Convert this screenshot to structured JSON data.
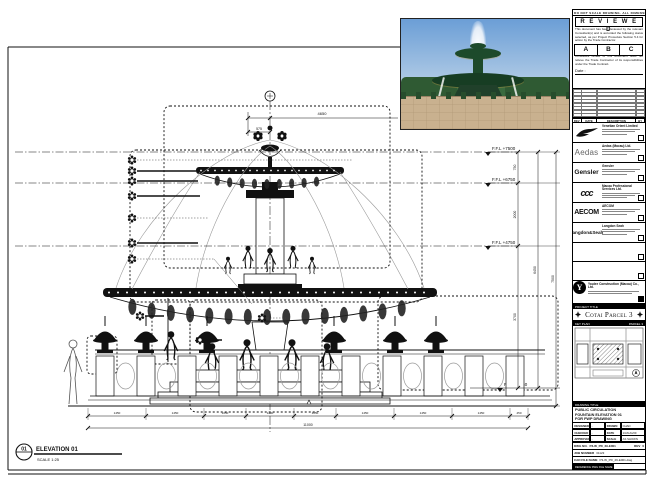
{
  "sheet_notes": {
    "top_strip": "DO NOT SCALE DRAWING. ALL DIMENSIONS TO BE VERIFIED ON SITE."
  },
  "stamp": {
    "title": "R E V I E W E D",
    "body1": "This document has been reviewed by the relevant Consultant(s) and is accorded the following status selected, as per Project Procedure Section 5.4 for action by the Trade Contractor.",
    "options": [
      "A",
      "B",
      "C"
    ],
    "body2": "Consultant review of this document does not relieve the Trade Contractor of its responsibilities under the Trade Contract.",
    "date_label": "Date :"
  },
  "revision_table": {
    "col_rev": "REV",
    "col_date": "DATE",
    "col_desc": "DESCRIPTION",
    "col_by": "BY"
  },
  "consultants": [
    {
      "name": "Venetian Orient Limited"
    },
    {
      "name": "Aedas (Macau) Ltd.",
      "logo_text": "Aedas"
    },
    {
      "name": "Gensler",
      "logo_text": "Gensler"
    },
    {
      "name": "Macau Professional Services Ltd.",
      "logo_text": "ccc"
    },
    {
      "name": "AECOM",
      "logo_text": "AECOM"
    },
    {
      "name": "Langdon Seah",
      "logo_text": "Langdon&Seah"
    }
  ],
  "contractor": {
    "name": "Youlee Construction (Macau) Co., Ltd.",
    "logo_letter": "Y"
  },
  "project": {
    "section_label": "PROJECT TITLE",
    "name": "Cotai Parcel 3"
  },
  "key_plan": {
    "section_label": "KEY PLAN",
    "parcel_label": "PARCEL 3"
  },
  "drawing_title": {
    "section_label": "DRAWING TITLE",
    "line1": "PUBLIC CIRCULATION",
    "line2": "FOUNTAIN ELEVATION 01",
    "line3": "FOR FWP DRAWING"
  },
  "title_fields": {
    "designed_label": "DESIGNED",
    "designed_value": "-",
    "drawn_label": "DRAWN",
    "drawn_value": "CHAD",
    "checked_label": "CHECKED",
    "checked_value": "-",
    "date_label": "DATE",
    "date_value": "13/AUG/09",
    "approved_label": "APPROVED",
    "approved_value": "-",
    "scale_label": "SCALE",
    "scale_value": "AS SHOWN",
    "dwg_no_label": "DWG NO.",
    "dwg_no_value": "P3-W_PD_29-E001",
    "rev_label": "REV",
    "rev_value": "0",
    "job_label": "JOB NUMBER",
    "job_value": "31123",
    "cad_label": "CAD FILE NAME",
    "cad_value": "P3-W_PD_29-E001.dwg",
    "ref_label": "REFERENCE DWG FILE NAME"
  },
  "elevation": {
    "bubble_number": "01",
    "title": "ELEVATION 01",
    "scale": "SCALE 1:25"
  },
  "levels": [
    {
      "label": "F.F.L +7500"
    },
    {
      "label": "F.F.L +6750"
    },
    {
      "label": "F.F.L +4750"
    },
    {
      "label": "F.F.L +1050"
    }
  ],
  "dimensions": {
    "top_main": "4650",
    "top_sub": "575",
    "right_segments": [
      "750",
      "2000",
      "3700"
    ],
    "right_sub_total": "6450",
    "right_total": "7500",
    "bottom_segments": [
      "1450",
      "1450",
      "1050",
      "1200",
      "1050",
      "1450",
      "1450",
      "1450",
      "450"
    ],
    "bottom_total": "11000"
  }
}
